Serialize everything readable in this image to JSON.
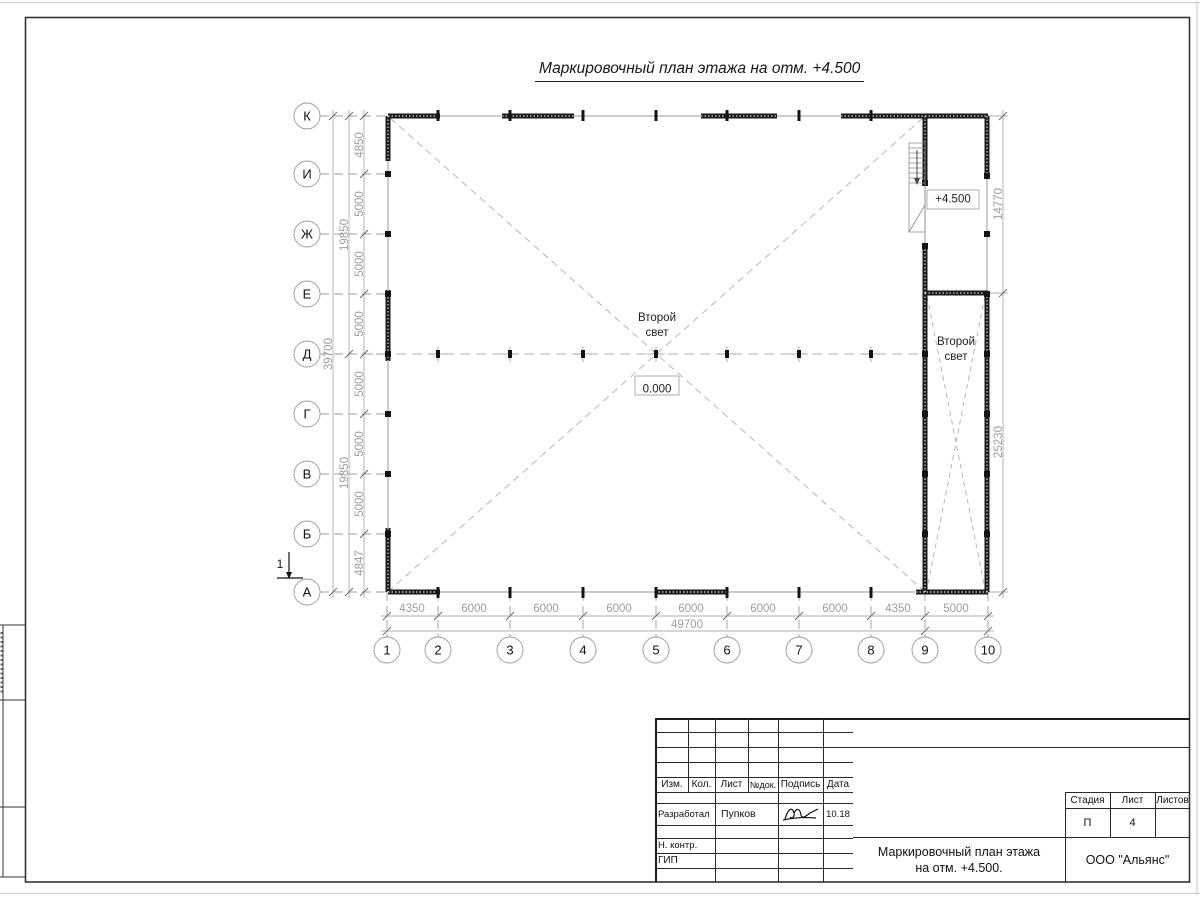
{
  "drawing_title": "Маркировочный план этажа на отм. +4.500",
  "plan": {
    "row_axes": [
      "К",
      "И",
      "Ж",
      "Е",
      "Д",
      "Г",
      "В",
      "Б",
      "А"
    ],
    "col_axes": [
      "1",
      "2",
      "3",
      "4",
      "5",
      "6",
      "7",
      "8",
      "9",
      "10"
    ],
    "left_dims": [
      "4850",
      "5000",
      "5000",
      "5000",
      "5000",
      "5000",
      "5000",
      "4847"
    ],
    "left_totals": [
      "19850",
      "19850"
    ],
    "left_grand": "39700",
    "bottom_dims": [
      "4350",
      "6000",
      "6000",
      "6000",
      "6000",
      "6000",
      "6000",
      "4350",
      "5000"
    ],
    "bottom_total": "49700",
    "right_dims": [
      "14770",
      "25230"
    ],
    "second_light": {
      "line1": "Второй",
      "line2": "свет"
    },
    "elev_zero": "0.000",
    "elev_450": "+4.500",
    "section_mark": "1"
  },
  "title_block": {
    "cols": [
      "Изм.",
      "Кол.",
      "Лист",
      "№док.",
      "Подпись",
      "Дата"
    ],
    "developed_label": "Разработал",
    "developed_name": "Пупков",
    "developed_date": "10.18",
    "ncontr_label": "Н. контр.",
    "gip_label": "ГИП",
    "stage_label": "Стадия",
    "sheet_label": "Лист",
    "sheets_label": "Листов",
    "stage_value": "П",
    "sheet_value": "4",
    "doc_title_line1": "Маркировочный план этажа",
    "doc_title_line2": "на отм. +4.500.",
    "org_name": "ООО \"Альянс\""
  }
}
